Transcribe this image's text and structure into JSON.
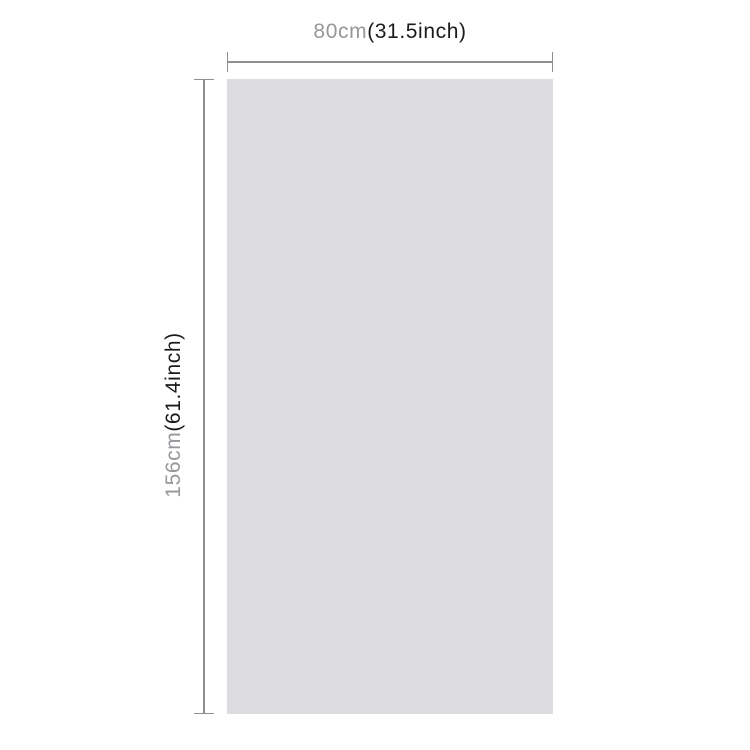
{
  "diagram": {
    "title": "product size dimension diagram",
    "panel": {
      "fill": "#dddce1"
    },
    "line_color": "#8f8f93",
    "text_colors": {
      "metric": "#97979b",
      "imperial": "#1b1b1b"
    },
    "width_dimension": {
      "metric": "80cm",
      "imperial": "(31.5inch)",
      "full": "80cm(31.5inch)"
    },
    "height_dimension": {
      "metric": "156cm",
      "imperial": "(61.4inch)",
      "full": "156cm(61.4inch)"
    }
  }
}
